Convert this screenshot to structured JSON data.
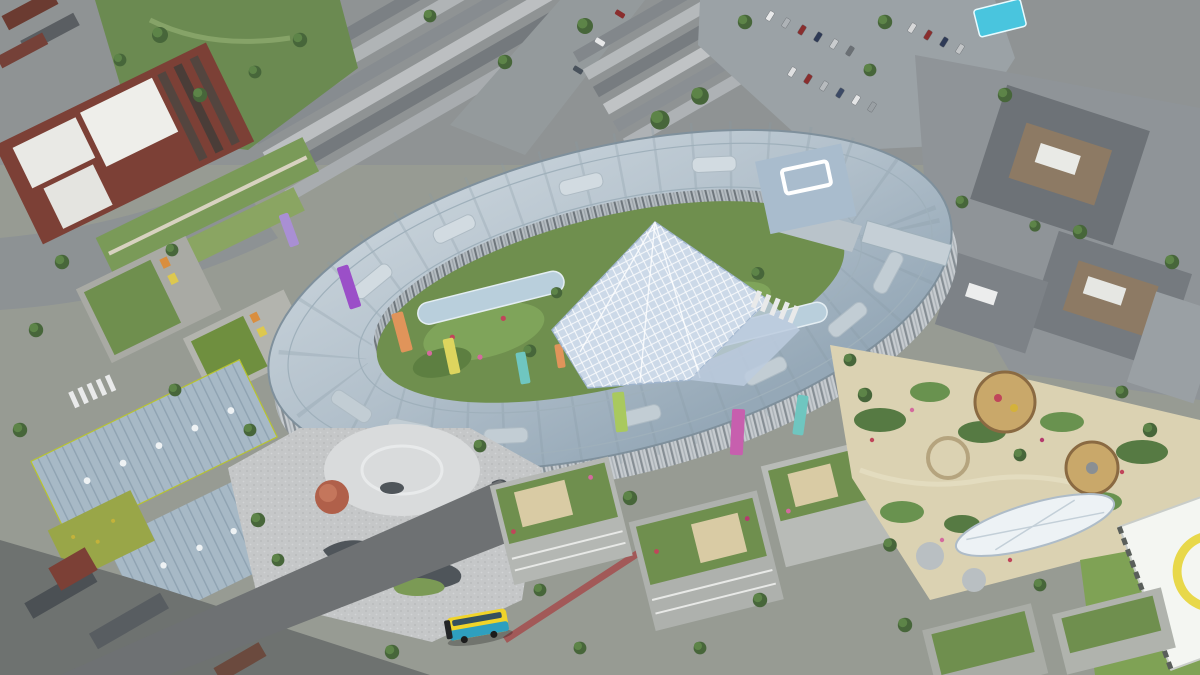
{
  "image": {
    "kind": "aerial-architectural-rendering",
    "subject": "oval-hospital-campus",
    "visible_text": ""
  },
  "palette": {
    "ground": "#979b93",
    "top_road": "#8d9294",
    "park_green": "#6b8a51",
    "brick": "#7c4036",
    "slate_roof": "#6d7277",
    "slate_roof_light": "#7d8287",
    "parking": "#9ba2a6",
    "tent_cyan": "#49c5de",
    "courtyard_green": "#6f8f4e",
    "atrium_glass": "#ccd9e8",
    "plaza": "#c6c8c9",
    "plaza_light": "#d9dbdc",
    "plaza_dark_shape": "#4f555a",
    "autumn_tree": "#b0604a",
    "road": "#6e7173",
    "cycle_lane": "#a34d4d",
    "bus_yellow": "#f0d42a",
    "bus_teal": "#2e9fbf",
    "garden_path": "#dbd2b2",
    "lawn_green": "#7fa255",
    "helipad_white": "#f4f6f2",
    "helipad_yellow": "#e8d84a",
    "metal_roof": "#a7b9c6",
    "block_grey": "#b4b7b3",
    "accent_fins": [
      "#a98fd4",
      "#9b4fc8",
      "#e0945a",
      "#ddd55e",
      "#6fc6c0",
      "#c75fae",
      "#a9c95e",
      "#e0945a",
      "#6fc6c0"
    ]
  }
}
